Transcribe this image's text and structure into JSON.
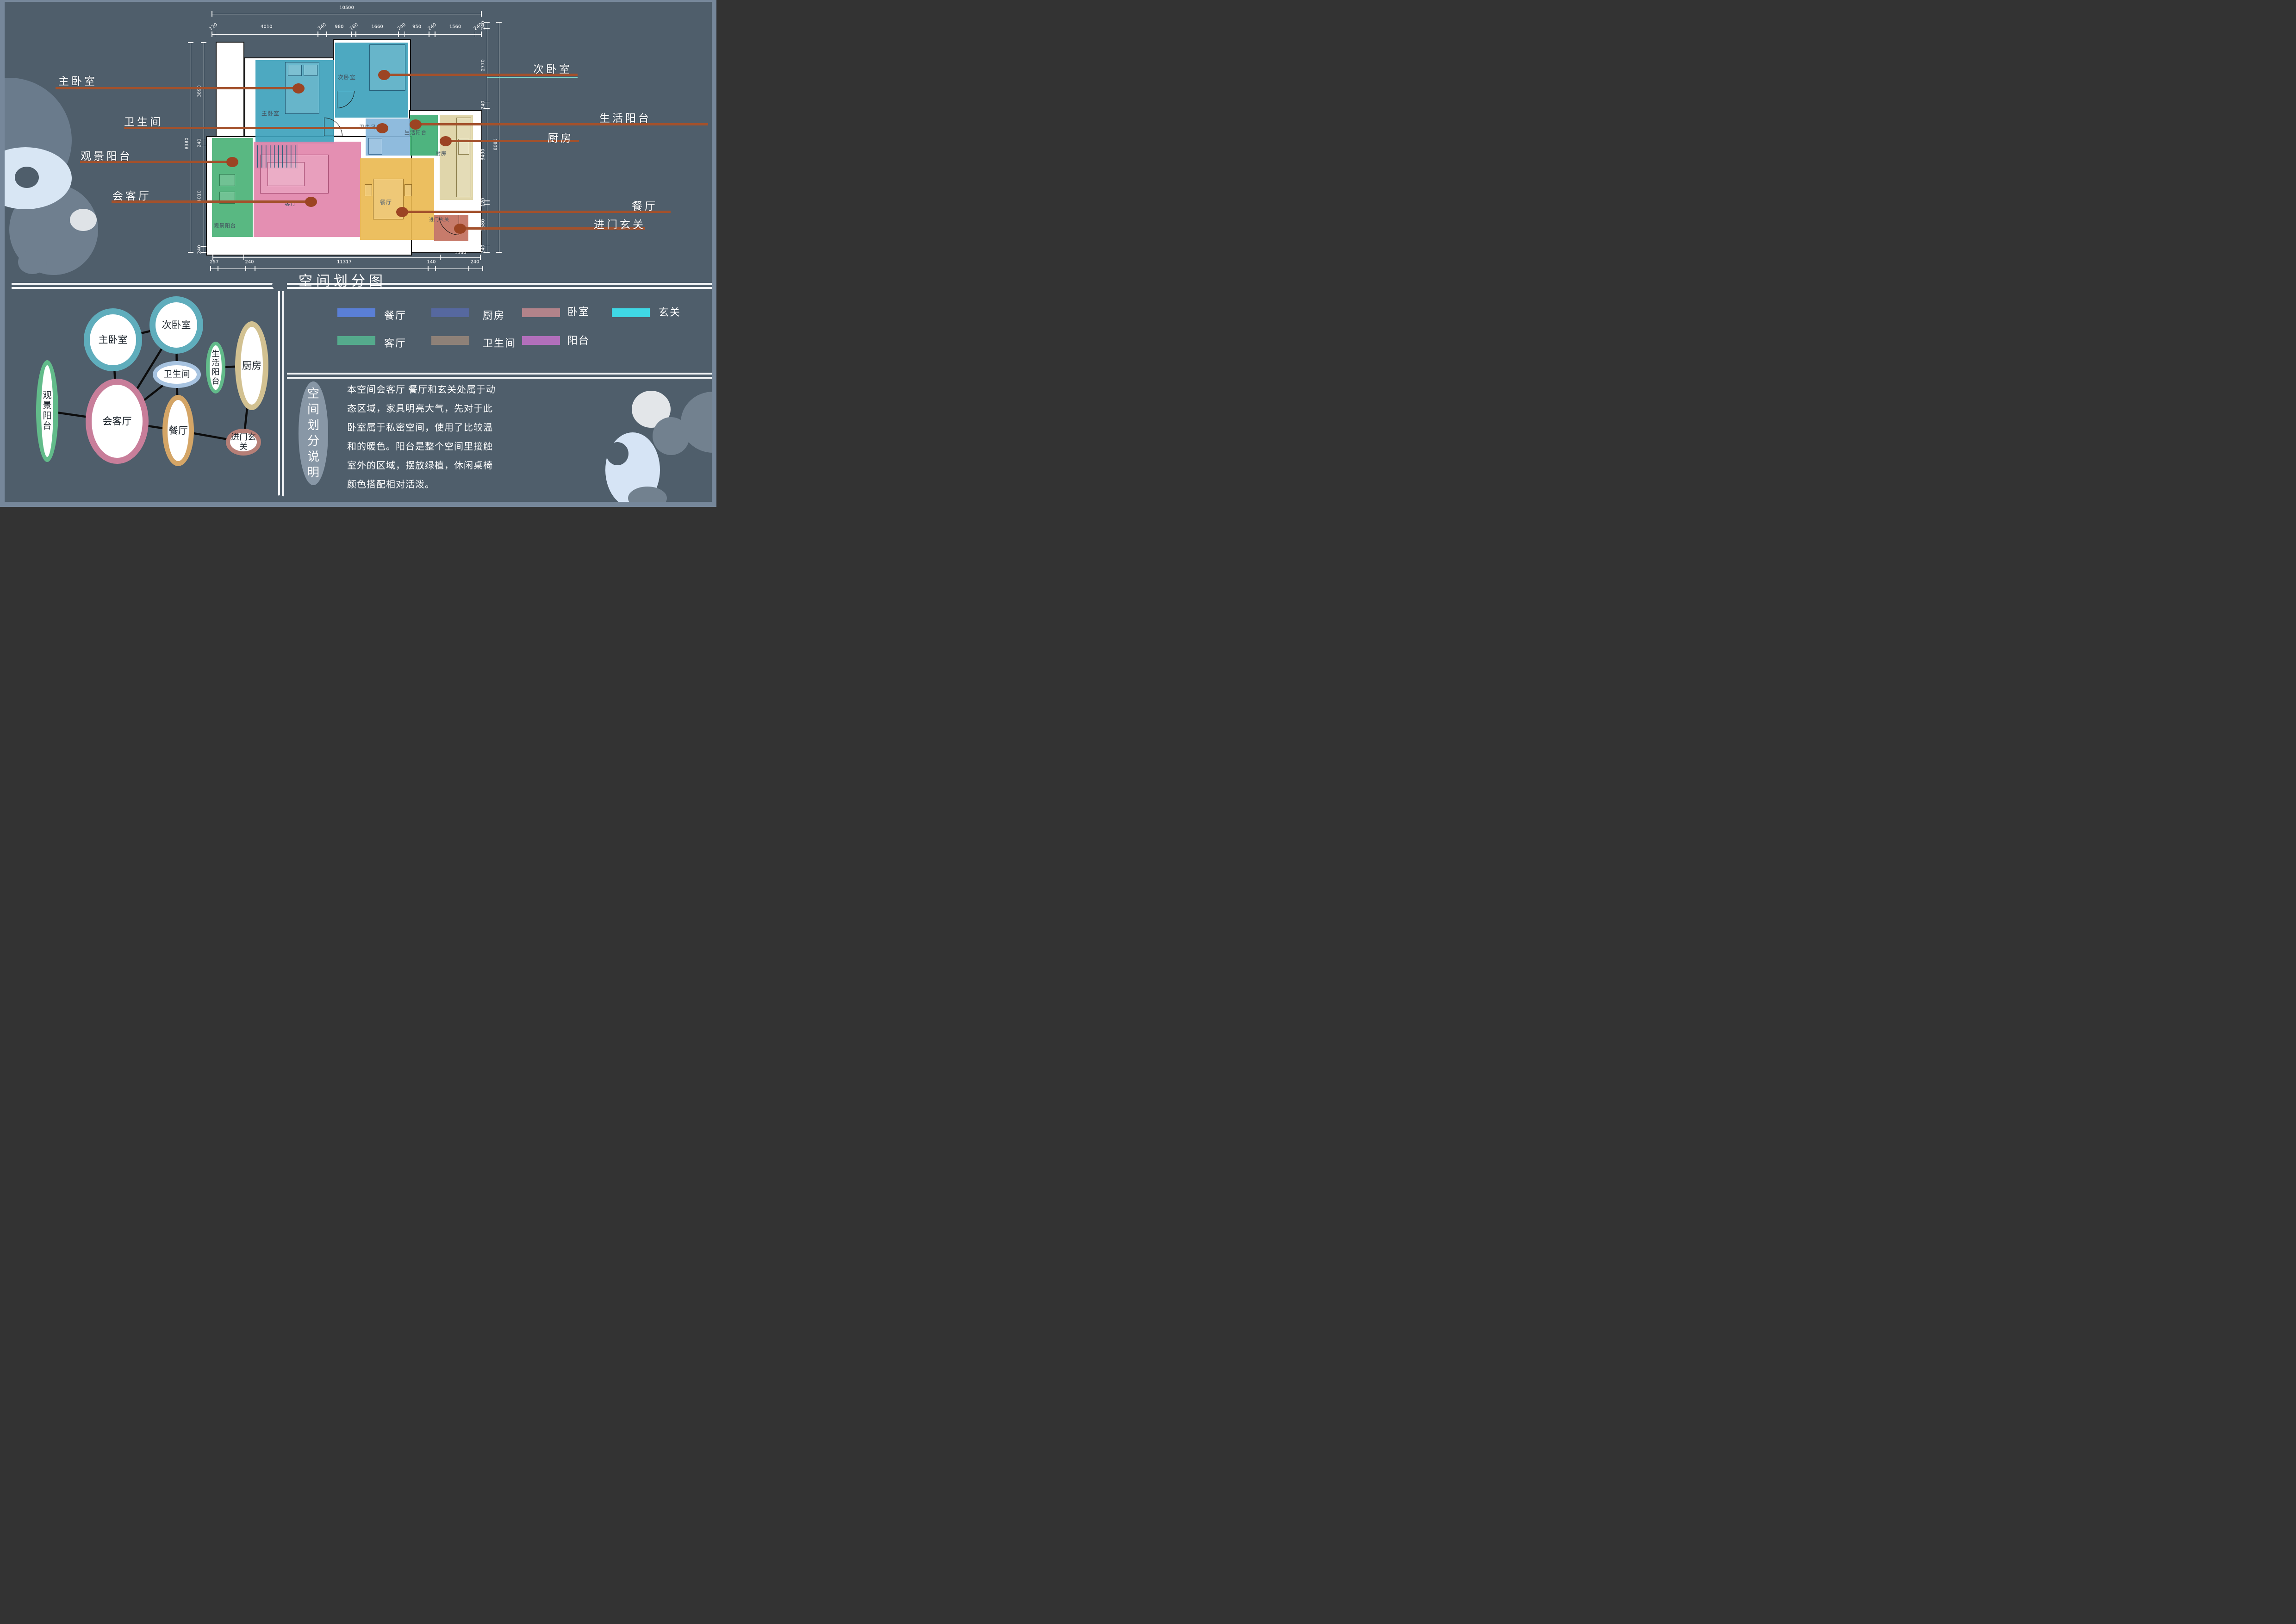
{
  "title": "空间划分图",
  "colors": {
    "background": "#4f5e6b",
    "frame": "#76879a",
    "callout_line": "#a3512c",
    "callout_dot": "#9c4423",
    "divider": "#f3f5f7",
    "dim_text": "#ffffff",
    "second_bed_underline": "#7fd4c8"
  },
  "plan": {
    "rooms": [
      {
        "id": "master_bedroom",
        "label": "主卧室",
        "color": "#3ea2bc"
      },
      {
        "id": "second_bedroom",
        "label": "次卧室",
        "color": "#3ea2bc"
      },
      {
        "id": "bathroom",
        "label": "卫生间",
        "color": "#86b5da"
      },
      {
        "id": "life_balcony",
        "label": "生活阳台",
        "color": "#3fae74"
      },
      {
        "id": "kitchen",
        "label": "厨房",
        "color": "#ddd2a4"
      },
      {
        "id": "view_balcony",
        "label": "观景阳台",
        "color": "#4bb277"
      },
      {
        "id": "living_room",
        "label": "客厅",
        "color": "#e286ab"
      },
      {
        "id": "dining_room",
        "label": "餐厅",
        "color": "#eaba52"
      },
      {
        "id": "entry",
        "label": "进门玄关",
        "color": "#c2705e"
      }
    ],
    "dimensions": {
      "top_total": "10500",
      "top_segments": [
        "120",
        "4010",
        "340",
        "980",
        "160",
        "1660",
        "240",
        "950",
        "240",
        "1560",
        "240"
      ],
      "bottom_upper": [
        "1200",
        "7680",
        "1560"
      ],
      "bottom_lower": [
        "257",
        "240",
        "11317",
        "140",
        "240"
      ],
      "left_total": "8380",
      "left_segments": [
        "3890",
        "240",
        "4010",
        "240"
      ],
      "right_total": "8080",
      "right_segments": [
        "240",
        "2770",
        "240",
        "3490",
        "120",
        "1580",
        "240"
      ]
    },
    "callouts": [
      {
        "id": "master_bedroom",
        "label": "主卧室"
      },
      {
        "id": "bathroom",
        "label": "卫生间"
      },
      {
        "id": "view_balcony",
        "label": "观景阳台"
      },
      {
        "id": "living_room",
        "label": "会客厅"
      },
      {
        "id": "second_bedroom",
        "label": "次卧室"
      },
      {
        "id": "life_balcony",
        "label": "生活阳台"
      },
      {
        "id": "kitchen",
        "label": "厨房"
      },
      {
        "id": "dining_room",
        "label": "餐厅"
      },
      {
        "id": "entry",
        "label": "进门玄关"
      }
    ]
  },
  "bubble_diagram": {
    "nodes": [
      {
        "id": "view_balcony",
        "label": "观景阳台",
        "ring": "#62bb8a",
        "vertical": true
      },
      {
        "id": "master_bedroom",
        "label": "主卧室",
        "ring": "#5fadbc",
        "vertical": false
      },
      {
        "id": "second_bedroom",
        "label": "次卧室",
        "ring": "#5fadbc",
        "vertical": false
      },
      {
        "id": "bathroom",
        "label": "卫生间",
        "ring": "#a7c3e0",
        "vertical": false
      },
      {
        "id": "living_room",
        "label": "会客厅",
        "ring": "#c87e9a",
        "vertical": false
      },
      {
        "id": "dining_room",
        "label": "餐厅",
        "ring": "#d4a566",
        "vertical": false
      },
      {
        "id": "life_balcony",
        "label": "生活阳台",
        "ring": "#62bb8a",
        "vertical": true
      },
      {
        "id": "kitchen",
        "label": "厨房",
        "ring": "#d2c191",
        "vertical": false
      },
      {
        "id": "entry",
        "label": "进门玄关",
        "ring": "#b67f77",
        "vertical": false
      }
    ],
    "links": [
      [
        "master_bedroom",
        "second_bedroom"
      ],
      [
        "master_bedroom",
        "living_room"
      ],
      [
        "second_bedroom",
        "living_room"
      ],
      [
        "second_bedroom",
        "bathroom"
      ],
      [
        "bathroom",
        "living_room"
      ],
      [
        "bathroom",
        "dining_room"
      ],
      [
        "living_room",
        "dining_room"
      ],
      [
        "living_room",
        "view_balcony"
      ],
      [
        "dining_room",
        "entry"
      ],
      [
        "life_balcony",
        "kitchen"
      ],
      [
        "kitchen",
        "entry"
      ]
    ]
  },
  "legend": {
    "rows": [
      [
        {
          "label": "餐厅",
          "color": "#5a7fd6"
        },
        {
          "label": "厨房",
          "color": "#56689f"
        },
        {
          "label": "卧室",
          "color": "#b2838a"
        },
        {
          "label": "玄关",
          "color": "#3fd8e5"
        }
      ],
      [
        {
          "label": "客厅",
          "color": "#55aa8c"
        },
        {
          "label": "卫生间",
          "color": "#8e8178"
        },
        {
          "label": "阳台",
          "color": "#b26fbb"
        }
      ]
    ]
  },
  "explanation": {
    "heading": "空间划分说明",
    "body_lines": [
      "本空间会客厅 餐厅和玄关处属于动",
      "态区域，家具明亮大气，先对于此",
      "卧室属于私密空间，使用了比较温",
      "和的暖色。阳台是整个空间里接触",
      "室外的区域，摆放绿植，休闲桌椅",
      "颜色搭配相对活泼。"
    ]
  }
}
